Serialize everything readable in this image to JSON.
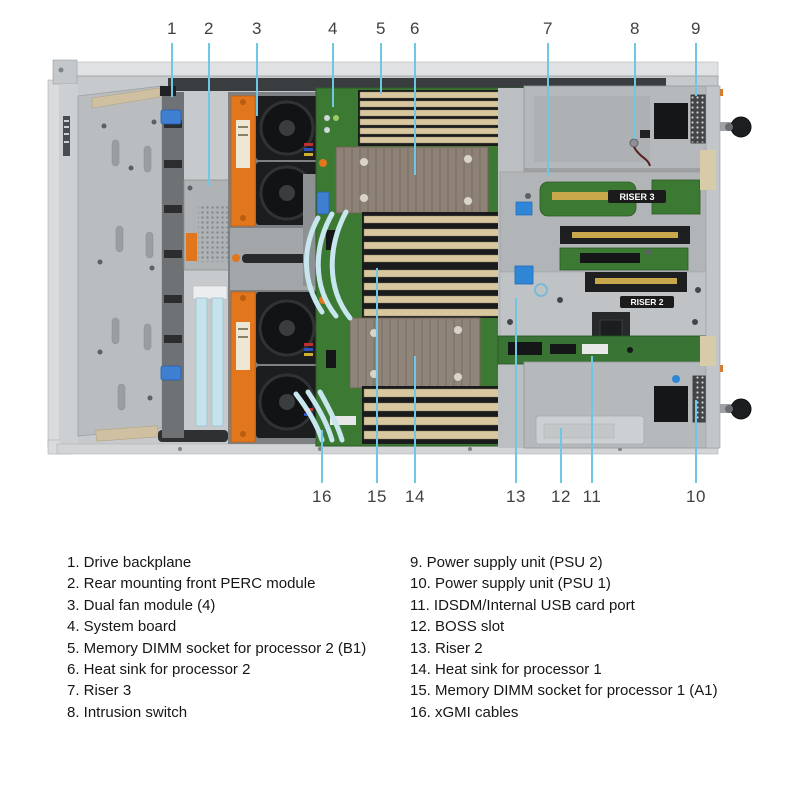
{
  "diagram": {
    "leader_color": "#6fc7e5",
    "number_color": "#414141",
    "callouts_top": [
      {
        "n": "1",
        "x": 172,
        "tip": 97
      },
      {
        "n": "2",
        "x": 209,
        "tip": 186
      },
      {
        "n": "3",
        "x": 257,
        "tip": 116
      },
      {
        "n": "4",
        "x": 333,
        "tip": 107
      },
      {
        "n": "5",
        "x": 381,
        "tip": 94
      },
      {
        "n": "6",
        "x": 415,
        "tip": 175
      },
      {
        "n": "7",
        "x": 548,
        "tip": 176
      },
      {
        "n": "8",
        "x": 635,
        "tip": 139
      },
      {
        "n": "9",
        "x": 696,
        "tip": 96
      }
    ],
    "callouts_bottom": [
      {
        "n": "16",
        "x": 322,
        "tip": 430
      },
      {
        "n": "15",
        "x": 377,
        "tip": 268
      },
      {
        "n": "14",
        "x": 415,
        "tip": 356
      },
      {
        "n": "13",
        "x": 516,
        "tip": 298
      },
      {
        "n": "12",
        "x": 561,
        "tip": 428
      },
      {
        "n": "11",
        "x": 592,
        "tip": 356
      },
      {
        "n": "10",
        "x": 696,
        "tip": 400
      }
    ],
    "labels": {
      "riser3": "RISER 3",
      "riser2": "RISER 2"
    }
  },
  "legend": {
    "left": [
      "1. Drive backplane",
      "2. Rear mounting front PERC module",
      "3. Dual fan module (4)",
      "4. System board",
      "5. Memory DIMM socket for processor 2 (B1)",
      "6. Heat sink for processor 2",
      "7. Riser 3",
      "8. Intrusion switch"
    ],
    "right": [
      "9. Power supply unit (PSU 2)",
      "10. Power supply unit (PSU 1)",
      "11. IDSDM/Internal USB card port",
      "12. BOSS slot",
      "13. Riser 2",
      "14. Heat sink for processor 1",
      "15. Memory DIMM socket for processor 1 (A1)",
      "16. xGMI cables"
    ]
  },
  "colors": {
    "fan_carrier_orange": "#e2761c",
    "pcb_green": "#3c7a33",
    "dimm_tan": "#d8c79f",
    "heatsink": "#8d8275",
    "chassis_gray": "#c7cacc",
    "cable_cyan": "#c8e6ee",
    "latch_blue": "#3f7fd2",
    "slot_gold": "#c9a84c"
  }
}
